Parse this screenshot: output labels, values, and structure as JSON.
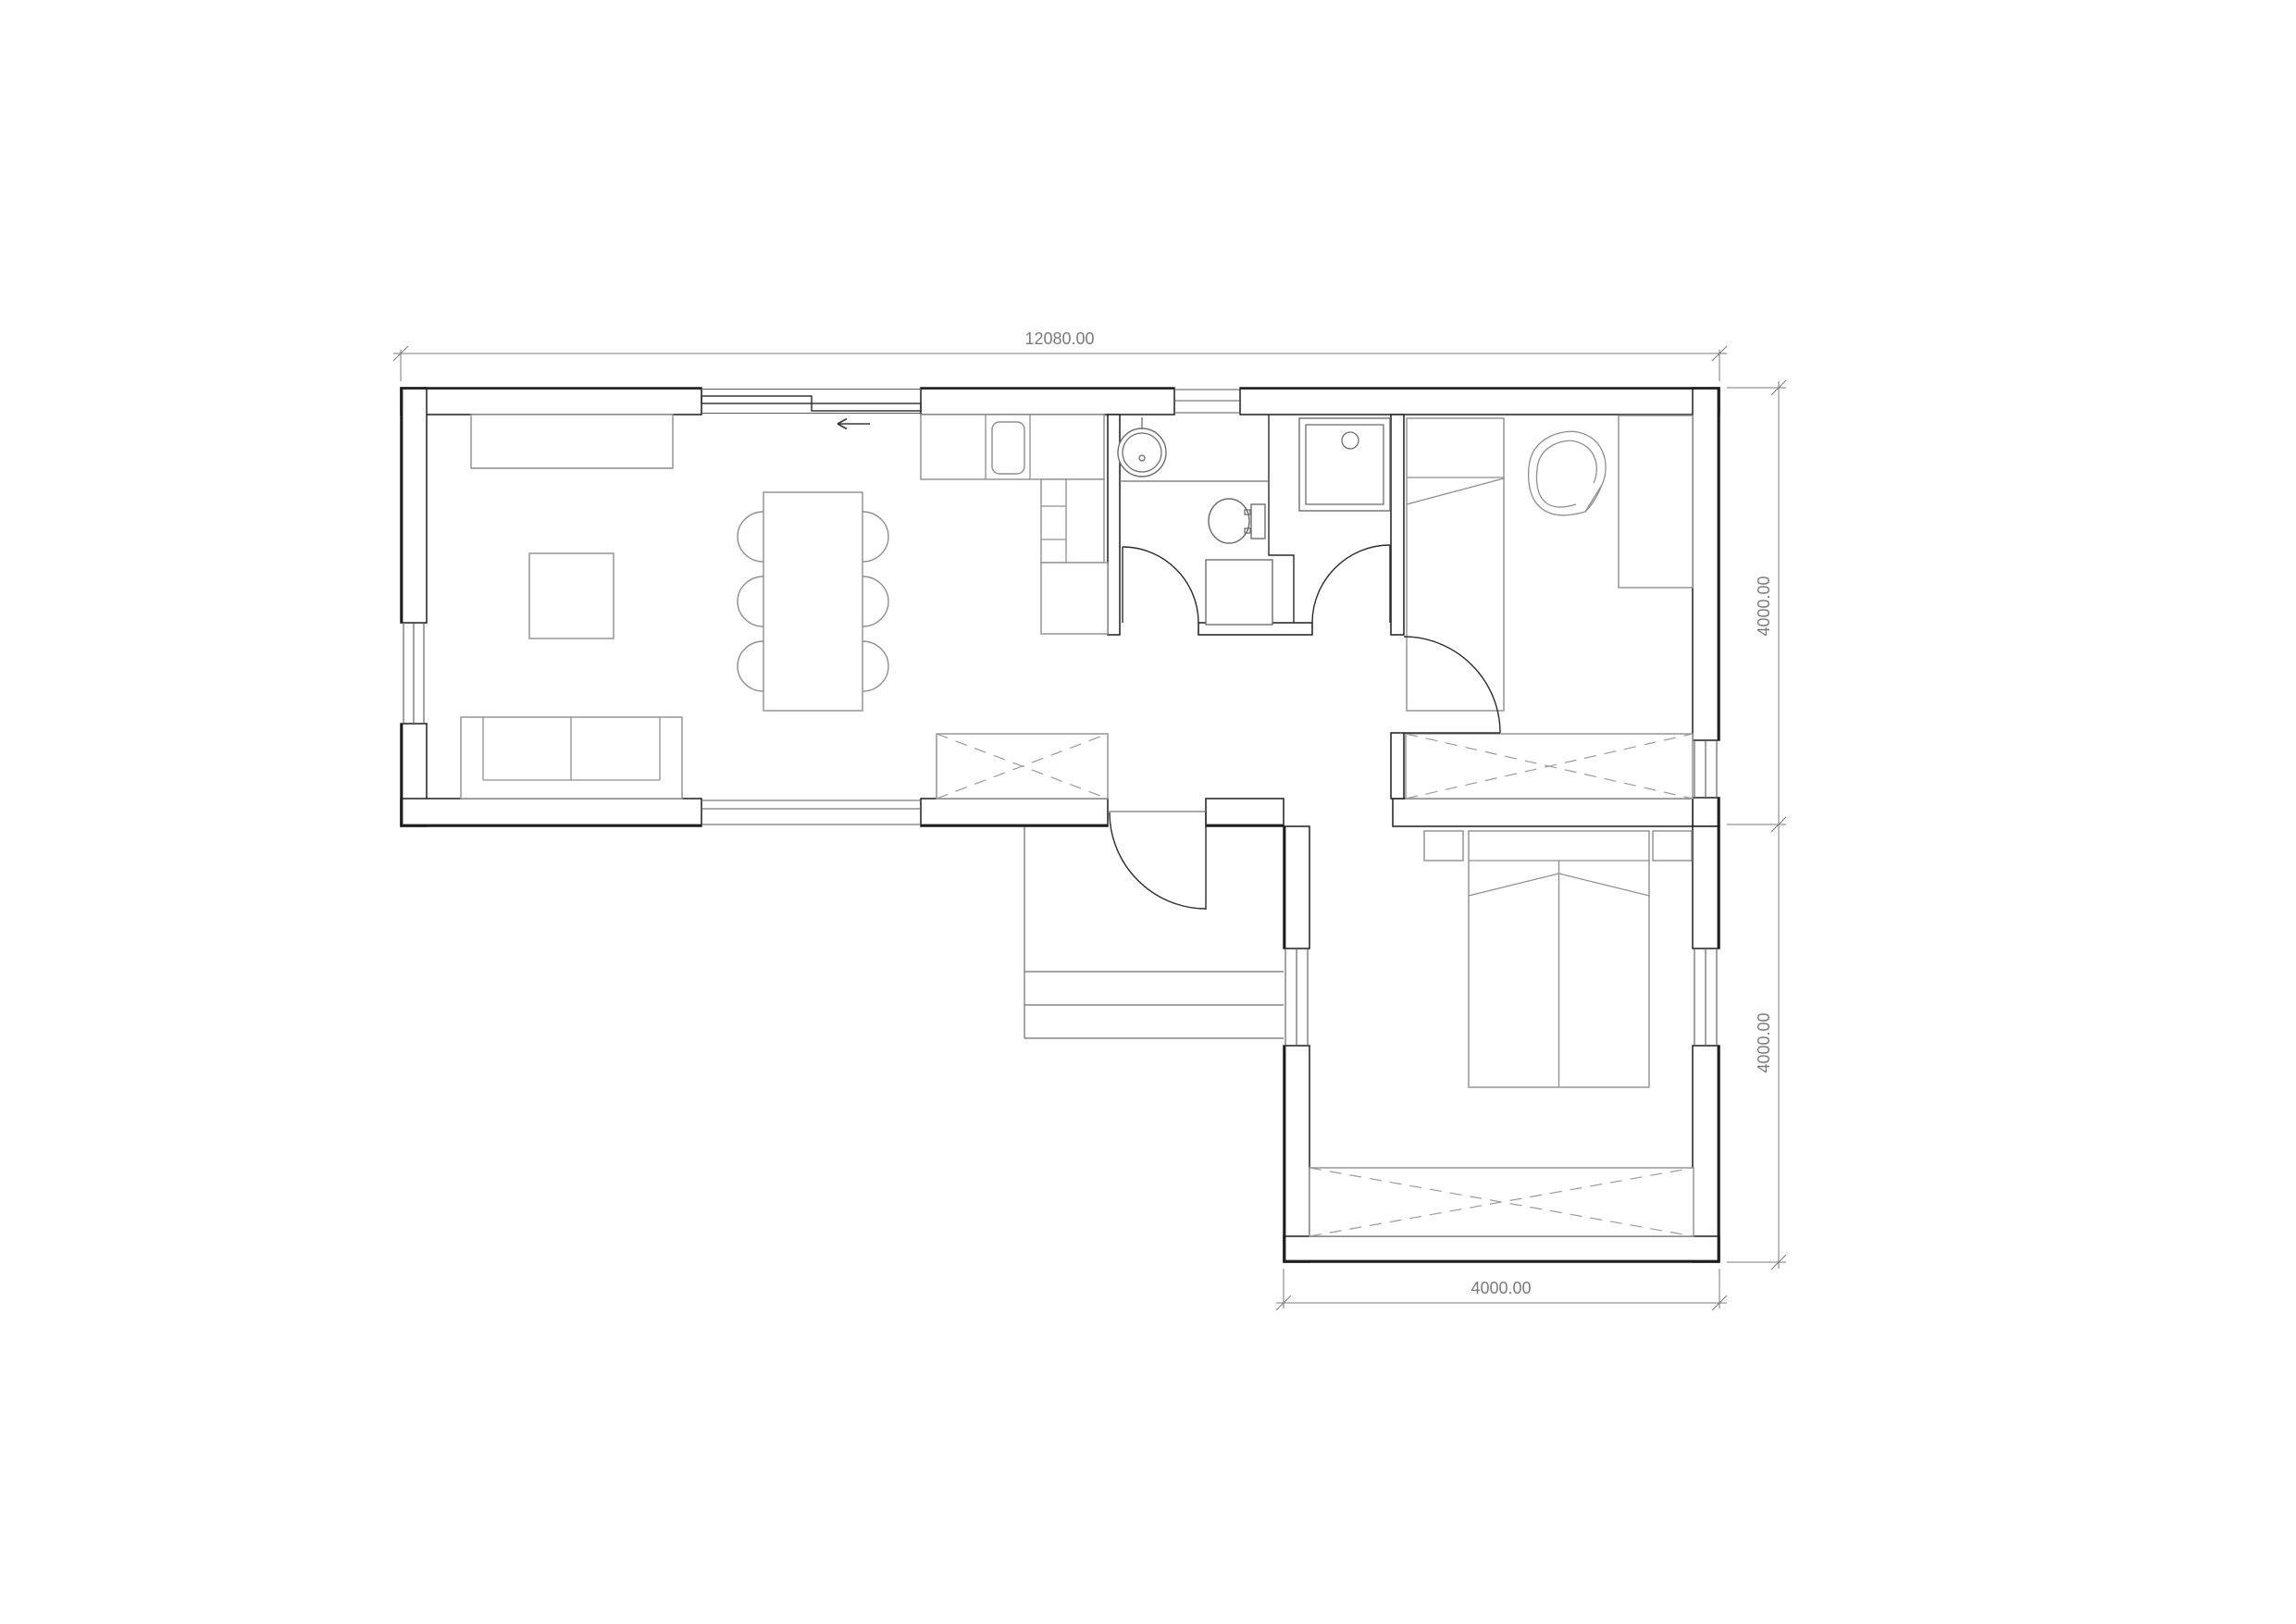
{
  "dimensions": {
    "top": "12080.00",
    "right_upper": "4000.00",
    "right_lower": "4000.00",
    "bottom": "4000.00"
  },
  "colors": {
    "wall": "#1e1e1e",
    "furniture": "#8f8f8f",
    "dimension": "#7b7b7b",
    "background": "#ffffff"
  }
}
